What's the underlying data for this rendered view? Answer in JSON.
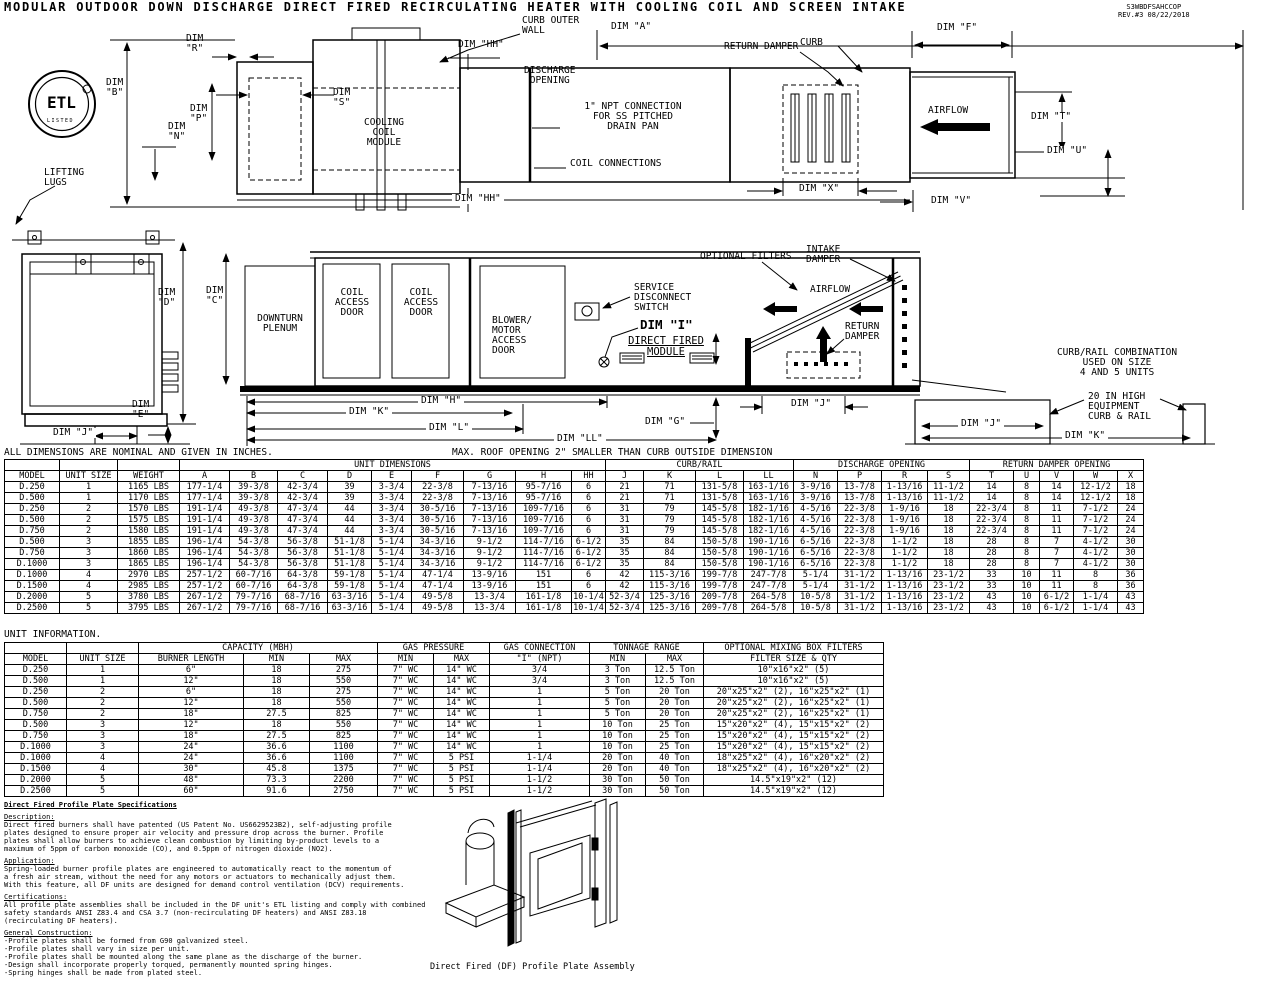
{
  "doc": {
    "title": "MODULAR OUTDOOR DOWN DISCHARGE DIRECT FIRED RECIRCULATING HEATER WITH COOLING COIL AND SCREEN INTAKE",
    "number_block": "S3WBDFSAHCCOP\nREV.#3   08/22/2018"
  },
  "logo": {
    "text": "ETL",
    "sub": "LISTED"
  },
  "labels": {
    "lifting_lugs": "LIFTING\nLUGS",
    "dim_b": "DIM\n\"B\"",
    "dim_r": "DIM\n\"R\"",
    "dim_n": "DIM\n\"N\"",
    "dim_p": "DIM\n\"P\"",
    "dim_s": "DIM\n\"S\"",
    "cooling_coil_module": "COOLING\nCOIL\nMODULE",
    "curb_outer_wall": "CURB OUTER\nWALL",
    "dim_hh_top": "DIM \"HH\"",
    "dim_hh_bot": "DIM \"HH\"",
    "dim_a": "DIM \"A\"",
    "dim_f": "DIM \"F\"",
    "discharge_opening": "DISCHARGE\nOPENING",
    "npt_connection": "1\" NPT CONNECTION\nFOR SS PITCHED\nDRAIN PAN",
    "coil_connections": "COIL CONNECTIONS",
    "return_damper": "RETURN DAMPER",
    "curb": "CURB",
    "airflow_top": "AIRFLOW",
    "dim_t": "DIM \"T\"",
    "dim_u": "DIM \"U\"",
    "dim_v": "DIM \"V\"",
    "dim_x": "DIM \"X\"",
    "dim_d": "DIM\n\"D\"",
    "dim_e": "DIM\n\"E\"",
    "dim_j_end": "DIM \"J\"",
    "dim_c": "DIM\n\"C\"",
    "downturn_plenum": "DOWNTURN\nPLENUM",
    "coil_access_door": "COIL\nACCESS\nDOOR",
    "blower_motor_door": "BLOWER/\nMOTOR\nACCESS\nDOOR",
    "service_disconnect": "SERVICE\nDISCONNECT\nSWITCH",
    "dim_i": "DIM \"I\"",
    "direct_fired_module": "DIRECT FIRED\nMODULE",
    "optional_filters": "OPTIONAL FILTERS",
    "intake_damper": "INTAKE\nDAMPER",
    "airflow_mid": "AIRFLOW",
    "return_damper_2": "RETURN\nDAMPER",
    "dim_h": "DIM \"H\"",
    "dim_k": "DIM \"K\"",
    "dim_l": "DIM \"L\"",
    "dim_ll": "DIM \"LL\"",
    "dim_g": "DIM \"G\"",
    "dim_j_mid": "DIM \"J\"",
    "curb_rail_note": "CURB/RAIL COMBINATION\nUSED ON SIZE\n4 AND 5 UNITS",
    "high_curb_note": "20 IN HIGH\nEQUIPMENT\nCURB & RAIL",
    "dim_j_curb": "DIM \"J\"",
    "dim_k_curb": "DIM \"K\""
  },
  "notes": {
    "dims_note": "ALL DIMENSIONS ARE NOMINAL AND GIVEN IN INCHES.",
    "roof_note": "MAX. ROOF OPENING 2\" SMALLER THAN CURB OUTSIDE DIMENSION",
    "unit_info": "UNIT INFORMATION."
  },
  "dim_table": {
    "groups": [
      {
        "label": "",
        "span": 1
      },
      {
        "label": "",
        "span": 1
      },
      {
        "label": "",
        "span": 1
      },
      {
        "label": "UNIT DIMENSIONS",
        "span": 9
      },
      {
        "label": "CURB/RAIL",
        "span": 4
      },
      {
        "label": "DISCHARGE OPENING",
        "span": 4
      },
      {
        "label": "RETURN DAMPER OPENING",
        "span": 5
      }
    ],
    "columns": [
      "MODEL",
      "UNIT SIZE",
      "WEIGHT",
      "A",
      "B",
      "C",
      "D",
      "E",
      "F",
      "G",
      "H",
      "HH",
      "J",
      "K",
      "L",
      "LL",
      "N",
      "P",
      "R",
      "S",
      "T",
      "U",
      "V",
      "W",
      "X"
    ],
    "rows": [
      [
        "D.250",
        "1",
        "1165 LBS",
        "177-1/4",
        "39-3/8",
        "42-3/4",
        "39",
        "3-3/4",
        "22-3/8",
        "7-13/16",
        "95-7/16",
        "6",
        "21",
        "71",
        "131-5/8",
        "163-1/16",
        "3-9/16",
        "13-7/8",
        "1-13/16",
        "11-1/2",
        "14",
        "8",
        "14",
        "12-1/2",
        "18"
      ],
      [
        "D.500",
        "1",
        "1170 LBS",
        "177-1/4",
        "39-3/8",
        "42-3/4",
        "39",
        "3-3/4",
        "22-3/8",
        "7-13/16",
        "95-7/16",
        "6",
        "21",
        "71",
        "131-5/8",
        "163-1/16",
        "3-9/16",
        "13-7/8",
        "1-13/16",
        "11-1/2",
        "14",
        "8",
        "14",
        "12-1/2",
        "18"
      ],
      [
        "D.250",
        "2",
        "1570 LBS",
        "191-1/4",
        "49-3/8",
        "47-3/4",
        "44",
        "3-3/4",
        "30-5/16",
        "7-13/16",
        "109-7/16",
        "6",
        "31",
        "79",
        "145-5/8",
        "182-1/16",
        "4-5/16",
        "22-3/8",
        "1-9/16",
        "18",
        "22-3/4",
        "8",
        "11",
        "7-1/2",
        "24"
      ],
      [
        "D.500",
        "2",
        "1575 LBS",
        "191-1/4",
        "49-3/8",
        "47-3/4",
        "44",
        "3-3/4",
        "30-5/16",
        "7-13/16",
        "109-7/16",
        "6",
        "31",
        "79",
        "145-5/8",
        "182-1/16",
        "4-5/16",
        "22-3/8",
        "1-9/16",
        "18",
        "22-3/4",
        "8",
        "11",
        "7-1/2",
        "24"
      ],
      [
        "D.750",
        "2",
        "1580 LBS",
        "191-1/4",
        "49-3/8",
        "47-3/4",
        "44",
        "3-3/4",
        "30-5/16",
        "7-13/16",
        "109-7/16",
        "6",
        "31",
        "79",
        "145-5/8",
        "182-1/16",
        "4-5/16",
        "22-3/8",
        "1-9/16",
        "18",
        "22-3/4",
        "8",
        "11",
        "7-1/2",
        "24"
      ],
      [
        "D.500",
        "3",
        "1855 LBS",
        "196-1/4",
        "54-3/8",
        "56-3/8",
        "51-1/8",
        "5-1/4",
        "34-3/16",
        "9-1/2",
        "114-7/16",
        "6-1/2",
        "35",
        "84",
        "150-5/8",
        "190-1/16",
        "6-5/16",
        "22-3/8",
        "1-1/2",
        "18",
        "28",
        "8",
        "7",
        "4-1/2",
        "30"
      ],
      [
        "D.750",
        "3",
        "1860 LBS",
        "196-1/4",
        "54-3/8",
        "56-3/8",
        "51-1/8",
        "5-1/4",
        "34-3/16",
        "9-1/2",
        "114-7/16",
        "6-1/2",
        "35",
        "84",
        "150-5/8",
        "190-1/16",
        "6-5/16",
        "22-3/8",
        "1-1/2",
        "18",
        "28",
        "8",
        "7",
        "4-1/2",
        "30"
      ],
      [
        "D.1000",
        "3",
        "1865 LBS",
        "196-1/4",
        "54-3/8",
        "56-3/8",
        "51-1/8",
        "5-1/4",
        "34-3/16",
        "9-1/2",
        "114-7/16",
        "6-1/2",
        "35",
        "84",
        "150-5/8",
        "190-1/16",
        "6-5/16",
        "22-3/8",
        "1-1/2",
        "18",
        "28",
        "8",
        "7",
        "4-1/2",
        "30"
      ],
      [
        "D.1000",
        "4",
        "2970 LBS",
        "257-1/2",
        "60-7/16",
        "64-3/8",
        "59-1/8",
        "5-1/4",
        "47-1/4",
        "13-9/16",
        "151",
        "6",
        "42",
        "115-3/16",
        "199-7/8",
        "247-7/8",
        "5-1/4",
        "31-1/2",
        "1-13/16",
        "23-1/2",
        "33",
        "10",
        "11",
        "8",
        "36"
      ],
      [
        "D.1500",
        "4",
        "2985 LBS",
        "257-1/2",
        "60-7/16",
        "64-3/8",
        "59-1/8",
        "5-1/4",
        "47-1/4",
        "13-9/16",
        "151",
        "6",
        "42",
        "115-3/16",
        "199-7/8",
        "247-7/8",
        "5-1/4",
        "31-1/2",
        "1-13/16",
        "23-1/2",
        "33",
        "10",
        "11",
        "8",
        "36"
      ],
      [
        "D.2000",
        "5",
        "3780 LBS",
        "267-1/2",
        "79-7/16",
        "68-7/16",
        "63-3/16",
        "5-1/4",
        "49-5/8",
        "13-3/4",
        "161-1/8",
        "10-1/4",
        "52-3/4",
        "125-3/16",
        "209-7/8",
        "264-5/8",
        "10-5/8",
        "31-1/2",
        "1-13/16",
        "23-1/2",
        "43",
        "10",
        "6-1/2",
        "1-1/4",
        "43"
      ],
      [
        "D.2500",
        "5",
        "3795 LBS",
        "267-1/2",
        "79-7/16",
        "68-7/16",
        "63-3/16",
        "5-1/4",
        "49-5/8",
        "13-3/4",
        "161-1/8",
        "10-1/4",
        "52-3/4",
        "125-3/16",
        "209-7/8",
        "264-5/8",
        "10-5/8",
        "31-1/2",
        "1-13/16",
        "23-1/2",
        "43",
        "10",
        "6-1/2",
        "1-1/4",
        "43"
      ]
    ]
  },
  "unit_table": {
    "groups": [
      {
        "label": "",
        "span": 1
      },
      {
        "label": "",
        "span": 1
      },
      {
        "label": "CAPACITY (MBH)",
        "span": 3
      },
      {
        "label": "GAS PRESSURE",
        "span": 2
      },
      {
        "label": "GAS CONNECTION",
        "span": 1
      },
      {
        "label": "TONNAGE RANGE",
        "span": 2
      },
      {
        "label": "OPTIONAL MIXING BOX FILTERS",
        "span": 1
      }
    ],
    "columns": [
      "MODEL",
      "UNIT SIZE",
      "BURNER LENGTH",
      "MIN",
      "MAX",
      "MIN",
      "MAX",
      "\"I\" (NPT)",
      "MIN",
      "MAX",
      "FILTER SIZE & QTY"
    ],
    "rows": [
      [
        "D.250",
        "1",
        "6\"",
        "18",
        "275",
        "7\" WC",
        "14\" WC",
        "3/4",
        "3 Ton",
        "12.5 Ton",
        "10\"x16\"x2\" (5)"
      ],
      [
        "D.500",
        "1",
        "12\"",
        "18",
        "550",
        "7\" WC",
        "14\" WC",
        "3/4",
        "3 Ton",
        "12.5 Ton",
        "10\"x16\"x2\" (5)"
      ],
      [
        "D.250",
        "2",
        "6\"",
        "18",
        "275",
        "7\" WC",
        "14\" WC",
        "1",
        "5 Ton",
        "20 Ton",
        "20\"x25\"x2\" (2), 16\"x25\"x2\" (1)"
      ],
      [
        "D.500",
        "2",
        "12\"",
        "18",
        "550",
        "7\" WC",
        "14\" WC",
        "1",
        "5 Ton",
        "20 Ton",
        "20\"x25\"x2\" (2), 16\"x25\"x2\" (1)"
      ],
      [
        "D.750",
        "2",
        "18\"",
        "27.5",
        "825",
        "7\" WC",
        "14\" WC",
        "1",
        "5 Ton",
        "20 Ton",
        "20\"x25\"x2\" (2), 16\"x25\"x2\" (1)"
      ],
      [
        "D.500",
        "3",
        "12\"",
        "18",
        "550",
        "7\" WC",
        "14\" WC",
        "1",
        "10 Ton",
        "25 Ton",
        "15\"x20\"x2\" (4), 15\"x15\"x2\" (2)"
      ],
      [
        "D.750",
        "3",
        "18\"",
        "27.5",
        "825",
        "7\" WC",
        "14\" WC",
        "1",
        "10 Ton",
        "25 Ton",
        "15\"x20\"x2\" (4), 15\"x15\"x2\" (2)"
      ],
      [
        "D.1000",
        "3",
        "24\"",
        "36.6",
        "1100",
        "7\" WC",
        "14\" WC",
        "1",
        "10 Ton",
        "25 Ton",
        "15\"x20\"x2\" (4), 15\"x15\"x2\" (2)"
      ],
      [
        "D.1000",
        "4",
        "24\"",
        "36.6",
        "1100",
        "7\" WC",
        "5 PSI",
        "1-1/4",
        "20 Ton",
        "40 Ton",
        "18\"x25\"x2\" (4), 16\"x20\"x2\" (2)"
      ],
      [
        "D.1500",
        "4",
        "30\"",
        "45.8",
        "1375",
        "7\" WC",
        "5 PSI",
        "1-1/4",
        "20 Ton",
        "40 Ton",
        "18\"x25\"x2\" (4), 16\"x20\"x2\" (2)"
      ],
      [
        "D.2000",
        "5",
        "48\"",
        "73.3",
        "2200",
        "7\" WC",
        "5 PSI",
        "1-1/2",
        "30 Ton",
        "50 Ton",
        "14.5\"x19\"x2\" (12)"
      ],
      [
        "D.2500",
        "5",
        "60\"",
        "91.6",
        "2750",
        "7\" WC",
        "5 PSI",
        "1-1/2",
        "30 Ton",
        "50 Ton",
        "14.5\"x19\"x2\" (12)"
      ]
    ]
  },
  "specs": {
    "heading": "Direct Fired Profile Plate Specifications",
    "sections": [
      {
        "title": "Description:",
        "body": "Direct fired burners shall have patented (US Patent No. US6629523B2), self-adjusting profile\nplates designed to ensure proper air velocity and pressure drop across the burner. Profile\nplates shall allow burners to achieve clean combustion by limiting by-product levels to a\nmaximum of 5ppm of carbon monoxide (CO), and 0.5ppm of nitrogen dioxide (NO2)."
      },
      {
        "title": "Application:",
        "body": "Spring-loaded burner profile plates are engineered to automatically react to the momentum of\na fresh air stream, without the need for any motors or actuators to mechanically adjust them.\nWith this feature, all DF units are designed for demand control ventilation (DCV) requirements."
      },
      {
        "title": "Certifications:",
        "body": "All profile plate assemblies shall be included in the DF unit's ETL listing and comply with combined\nsafety standards ANSI Z83.4 and CSA 3.7 (non-recirculating DF heaters) and ANSI Z83.18\n(recirculating DF heaters)."
      },
      {
        "title": "General Construction:",
        "body": "-Profile plates shall be formed from G90 galvanized steel.\n-Profile plates shall vary in size per unit.\n-Profile plates shall be mounted along the same plane as the discharge of the burner.\n-Design shall incorporate properly torqued, permanently mounted spring hinges.\n-Spring hinges shall be made from plated steel."
      }
    ]
  },
  "assembly_caption": "Direct Fired (DF) Profile Plate Assembly"
}
